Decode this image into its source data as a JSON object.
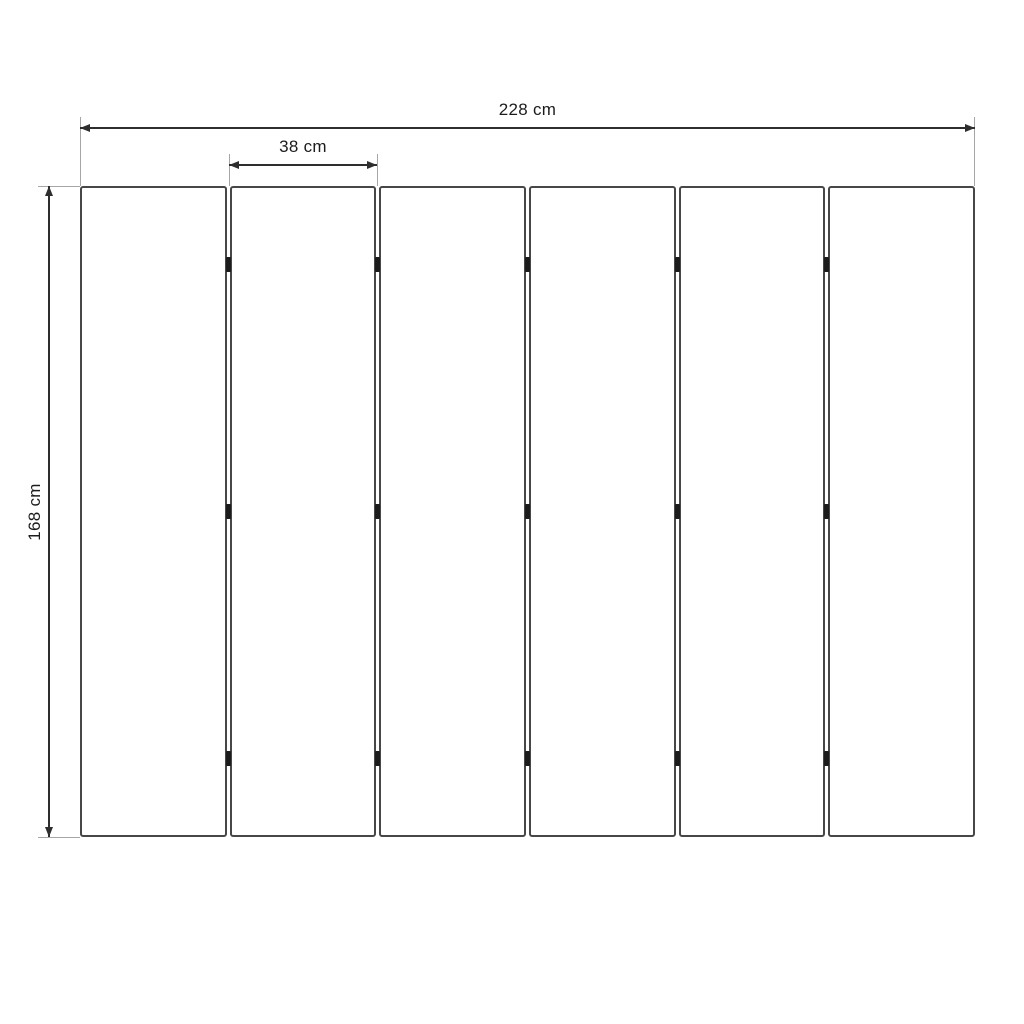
{
  "diagram": {
    "type": "dimension-drawing",
    "subject": "six-panel folding screen front view",
    "panel_count": 6,
    "hinge_rows": 3,
    "dimensions": {
      "total_width_label": "228 cm",
      "panel_width_label": "38 cm",
      "height_label": "168 cm"
    },
    "colors": {
      "background": "#ffffff",
      "panel_border": "#474747",
      "dimension_line": "#2e2e2e",
      "extension_line": "#a6a6a6",
      "hinge": "#1c1c1c",
      "label_text": "#1c1c1c"
    }
  }
}
